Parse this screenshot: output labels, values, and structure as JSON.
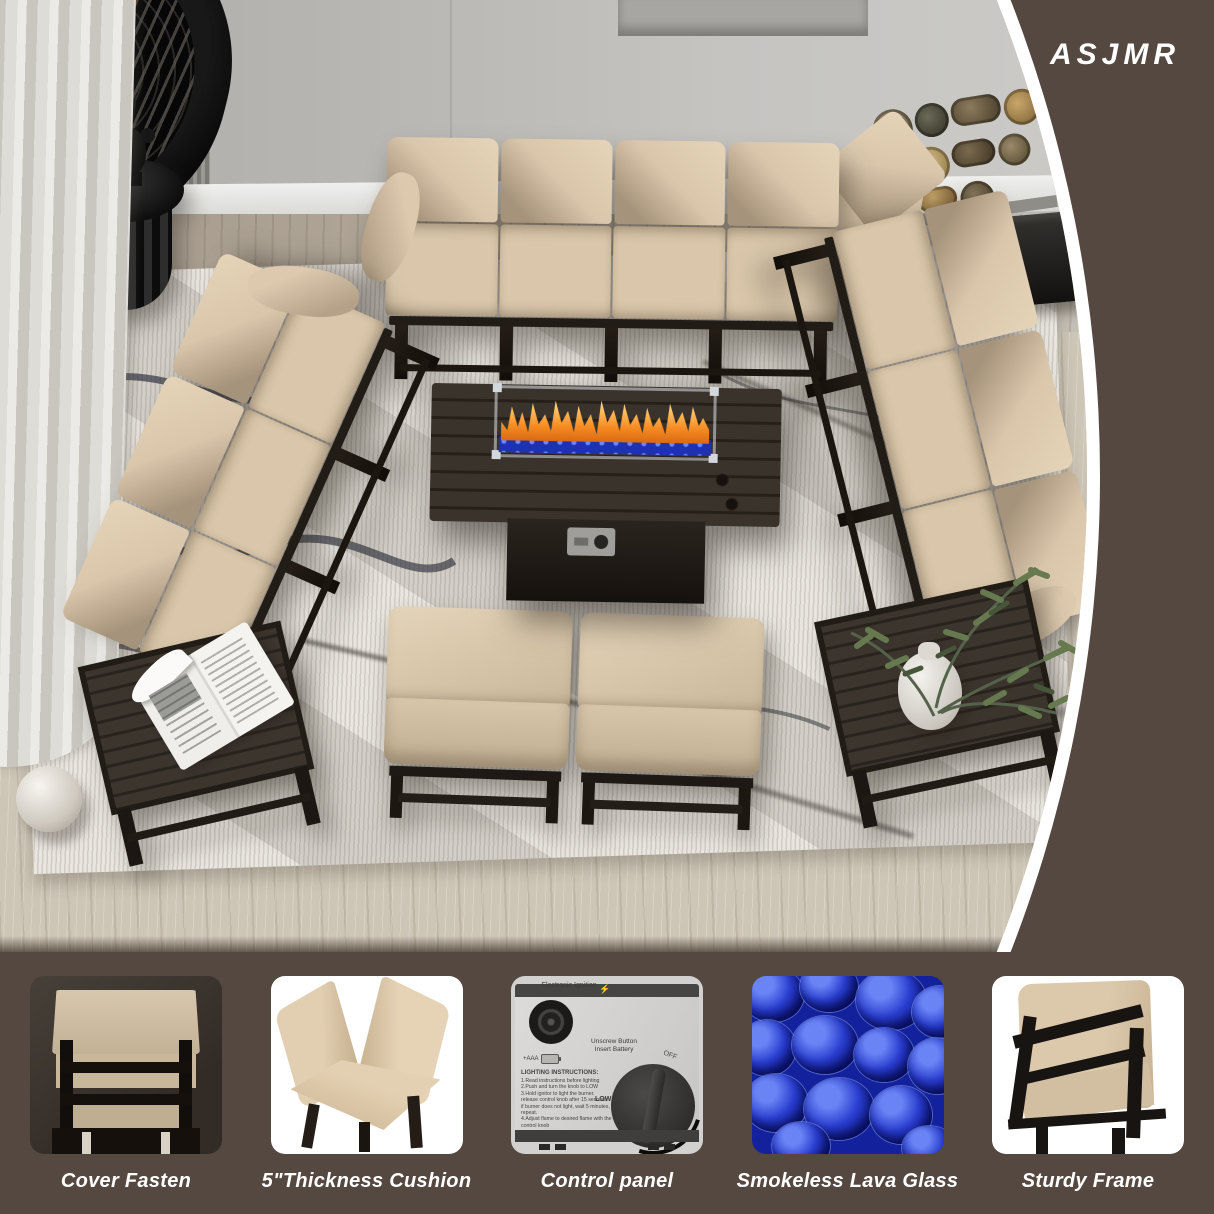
{
  "brand": "ASJMR",
  "features": [
    {
      "caption": "Cover Fasten"
    },
    {
      "caption": "5\"Thickness Cushion"
    },
    {
      "caption": "Control panel"
    },
    {
      "caption": "Smokeless Lava Glass"
    },
    {
      "caption": "Sturdy Frame"
    }
  ],
  "control_panel": {
    "ignition_label": "Electronic Ignition",
    "lightning": "⚡",
    "battery_label": "+AAA",
    "unscrew_button": "Unscrew Button",
    "insert_battery": "Insert Battery",
    "instructions_title": "LIGHTING INSTRUCTIONS:",
    "instructions": [
      "1.Read instructions before lighting",
      "2.Push and turn the knob to LOW",
      "3.Hold ignitor to light the burner.",
      "release control knob after 15 seconds",
      "if burner does not light, wait 5 minutes, repeat.",
      "4.Adjust flame to desired flame with the control knob"
    ],
    "knob_off": "OFF",
    "knob_low": "LOW",
    "knob_high": "HIGH"
  },
  "colors": {
    "background_brown": "#554840",
    "cushion_beige": "#d8c5aa",
    "frame_black": "#1d1813",
    "lava_blue": "#1e31b4",
    "flame_orange": "#f68b22",
    "rug_light": "#e9e6e0"
  }
}
